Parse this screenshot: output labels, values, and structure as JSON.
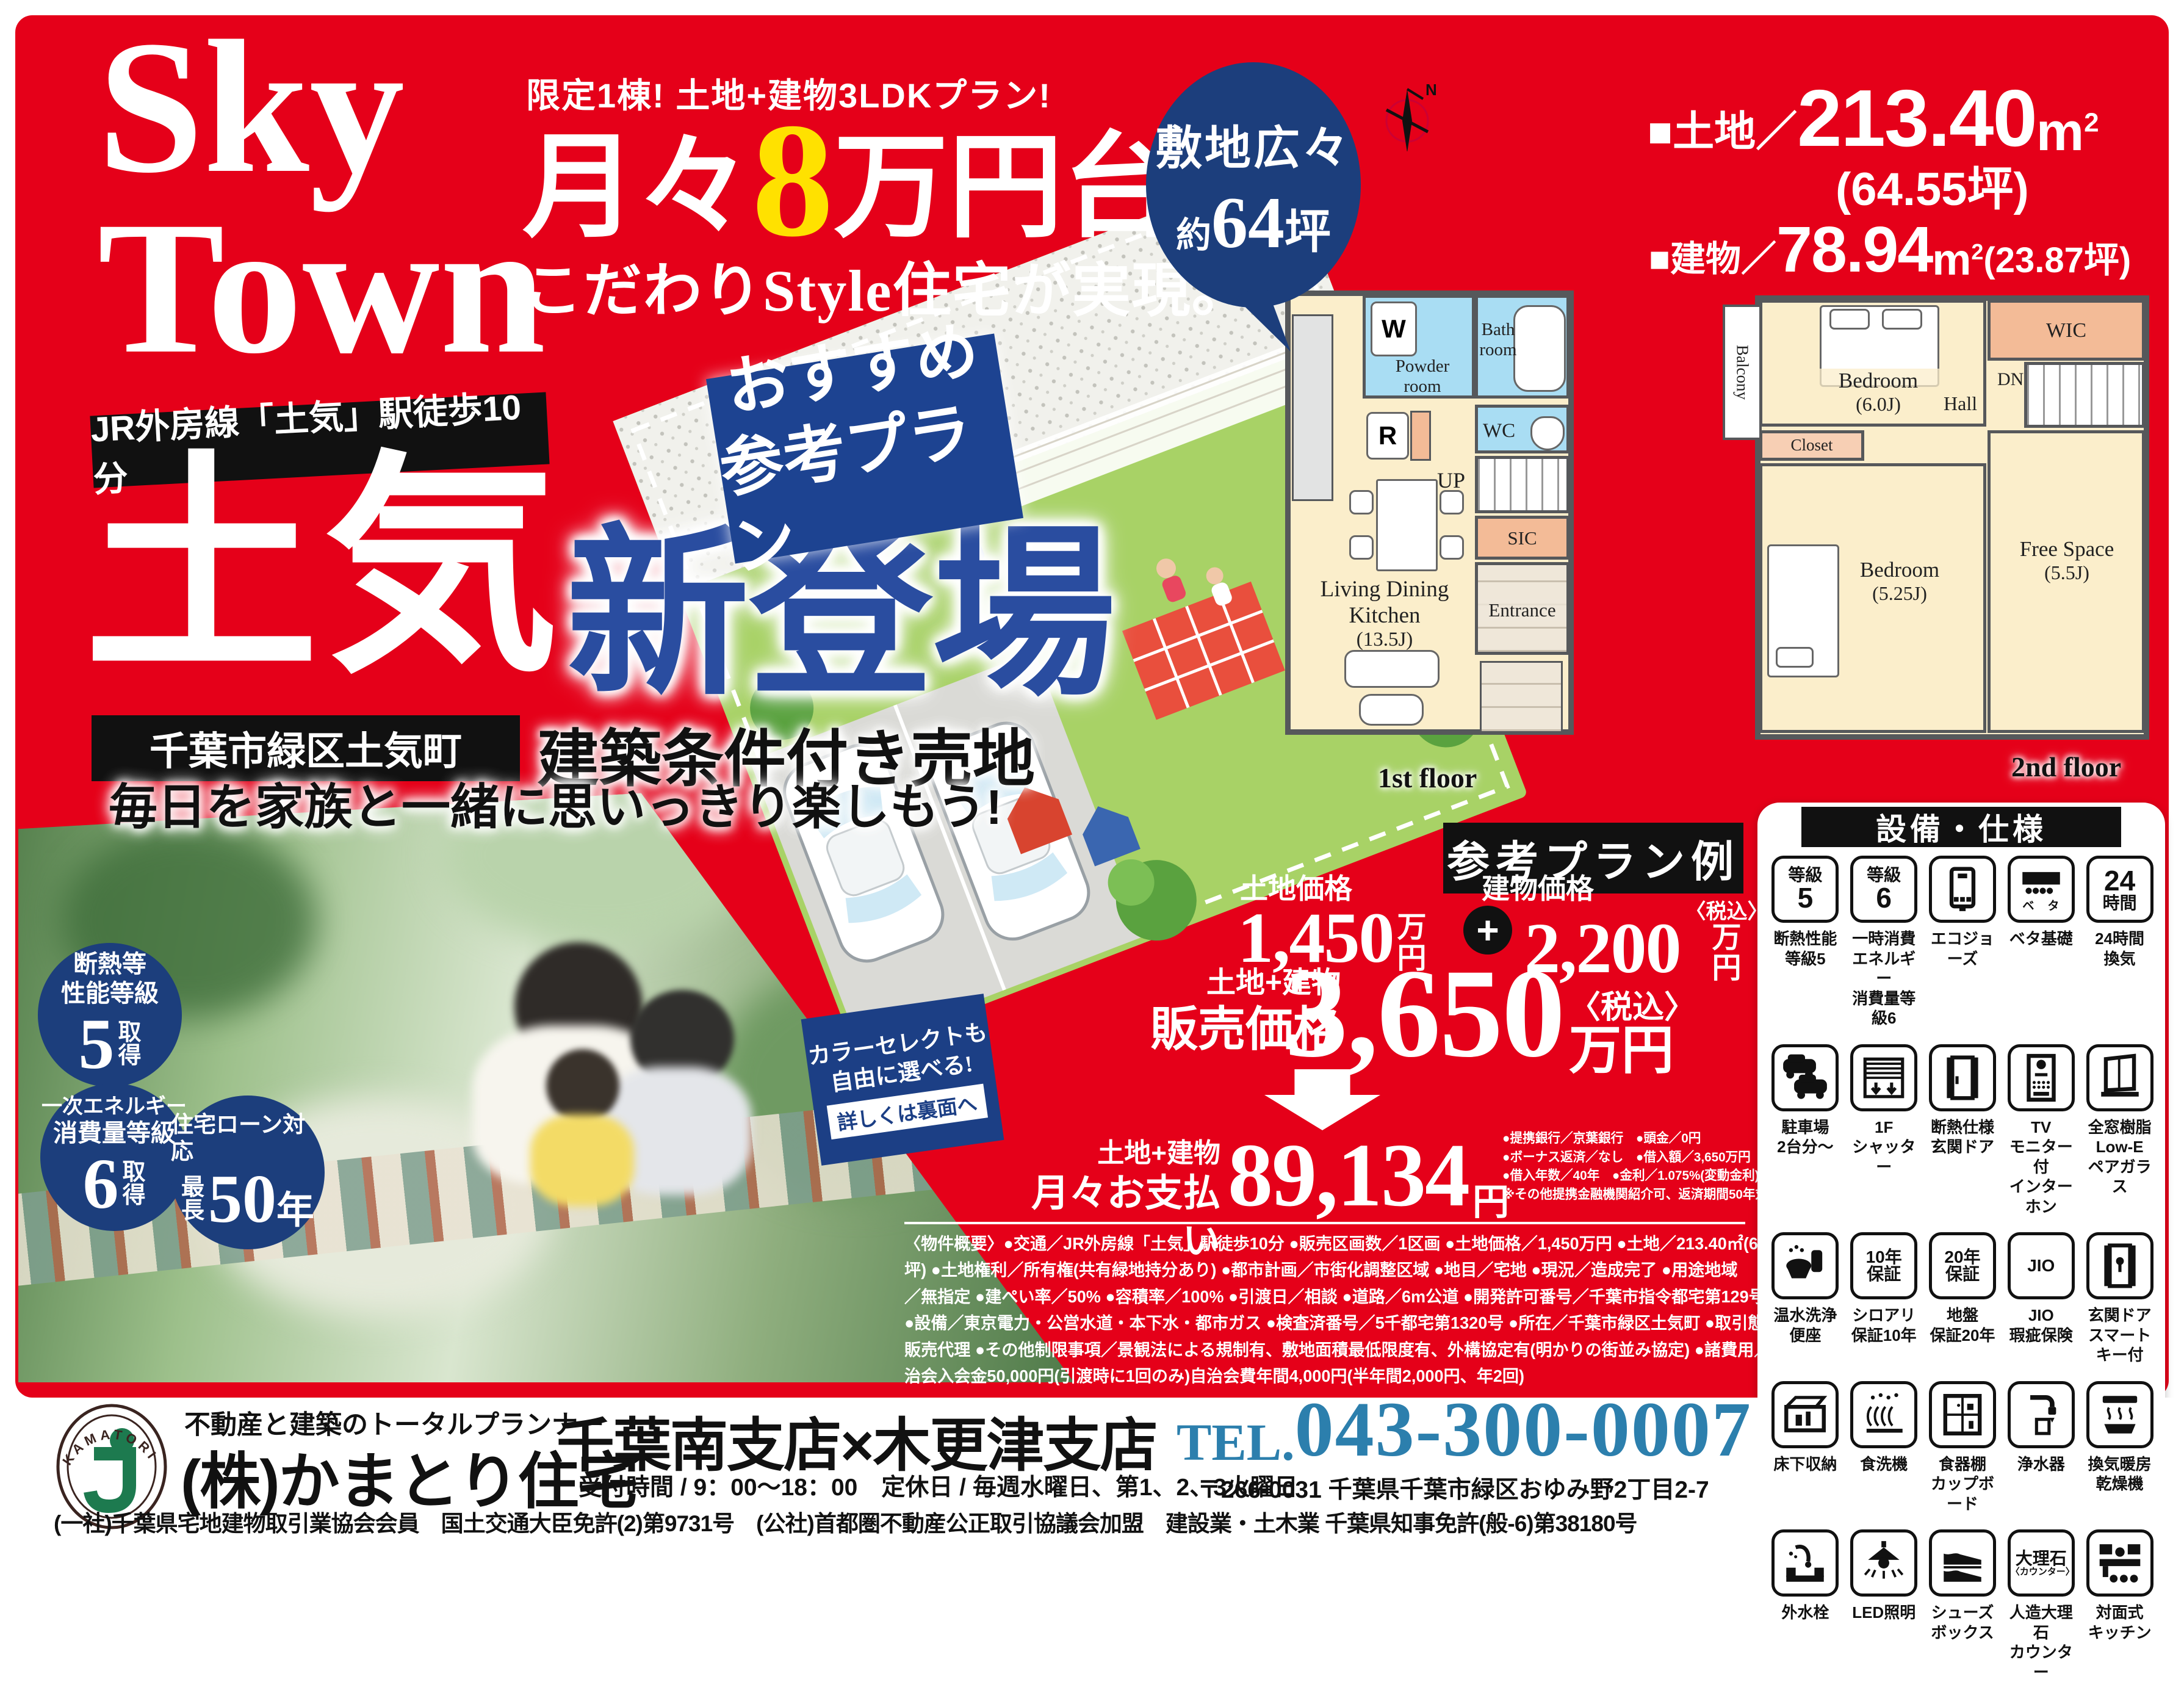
{
  "colors": {
    "red": "#e50019",
    "navy": "#1c3e7c",
    "blue": "#2a4da0",
    "badge_blue": "#1d4391",
    "tel_blue": "#2c7fad",
    "yellow": "#ffe100",
    "room_cream": "#fbeecb",
    "room_blue": "#a9ddf3",
    "room_peach": "#f3bb97",
    "wall_gray": "#56585b",
    "lawn_green": "#a8d266"
  },
  "hero": {
    "sky": "Sky",
    "town": "Town",
    "limited": "限定1棟! 土地+建物3LDKプラン!",
    "monthly_copy": {
      "pre": "月々",
      "num": "8",
      "post": "万円台で"
    },
    "kodawari": "こだわりStyle住宅が実現。",
    "station_badge": "JR外房線「土気」駅徒歩10分",
    "toke": "土気",
    "debut": "新登場",
    "osusume_l1": "おすすめ",
    "osusume_l2": "参考プラン",
    "area_badge": "千葉市緑区土気町",
    "joken": "建築条件付き売地",
    "tagline": "毎日を家族と一緒に思いっきり楽しもう!"
  },
  "site": {
    "bubble_l1": "敷地広々",
    "bubble_yaku": "約",
    "bubble_num": "64",
    "bubble_tsubo": "坪",
    "land_label": "■土地／",
    "land_num": "213.40",
    "land_unit": "m",
    "land_sup": "2",
    "land_tsubo": "(64.55坪)",
    "bldg_label": "■建物／",
    "bldg_num": "78.94",
    "bldg_unit": "m",
    "bldg_sup": "2",
    "bldg_tsubo": "(23.87坪)",
    "compass_n": "N"
  },
  "fp1": {
    "w": "W",
    "powder": "Powder room",
    "bath": "Bath room",
    "r": "R",
    "wc": "WC",
    "up": "UP",
    "sic": "SIC",
    "ldk1": "Living Dining",
    "ldk2": "Kitchen",
    "ldk3": "(13.5J)",
    "entrance": "Entrance",
    "floor": "1st floor"
  },
  "fp2": {
    "balcony": "Balcony",
    "bed1a": "Bedroom",
    "bed1b": "(6.0J)",
    "wic": "WIC",
    "dn": "DN",
    "hall": "Hall",
    "closet": "Closet",
    "bed2a": "Bedroom",
    "bed2b": "(5.25J)",
    "freea": "Free Space",
    "freeb": "(5.5J)",
    "floor": "2nd floor"
  },
  "badges": {
    "b1": {
      "l1": "断熱等",
      "l2": "性能等級",
      "num": "5",
      "suf1": "取",
      "suf2": "得"
    },
    "b2": {
      "l1": "一次エネルギー",
      "l2": "消費量等級",
      "num": "6",
      "suf1": "取",
      "suf2": "得"
    },
    "b3": {
      "l1": "住宅ローン対応",
      "pre1": "最",
      "pre2": "長",
      "num": "50",
      "suf": "年"
    }
  },
  "color_select": {
    "l1": "カラーセレクトも",
    "l2": "自由に選べる!",
    "link": "詳しくは裏面へ"
  },
  "plan": {
    "banner": "参考プラン例",
    "land_price_label": "土地価格",
    "land_price": "1,450",
    "man": "万",
    "en": "円",
    "plus": "+",
    "bldg_price_label": "建物価格",
    "bldg_price": "2,200",
    "tax": "〈税込〉",
    "total_label_a": "土地+建物",
    "total_label_b": "販売価格",
    "total": "3,650",
    "total_unit": "万円",
    "monthly_label_a": "土地+建物",
    "monthly_label_b": "月々お支払い",
    "monthly": "89,134",
    "monthly_unit": "円",
    "loan_notes": [
      "●提携銀行／京葉銀行　●頭金／0円",
      "●ボーナス返済／なし　●借入額／3,650万円",
      "●借入年数／40年　●金利／1.075%(変動金利)",
      "※その他提携金融機関紹介可、返済期間50年対応可"
    ]
  },
  "overview": {
    "lines": [
      "〈物件概要〉●交通／JR外房線「土気」駅徒歩10分 ●販売区画数／1区画 ●土地価格／1,450万円 ●土地／213.40㎡(64.55",
      "坪) ●土地権利／所有権(共有緑地持分あり) ●都市計画／市街化調整区域 ●地目／宅地 ●現況／造成完了 ●用途地域",
      "／無指定 ●建ぺい率／50% ●容積率／100% ●引渡日／相談 ●道路／6m公道 ●開発許可番号／千葉市指令都宅第129号",
      "●設備／東京電力・公営水道・本下水・都市ガス ●検査済番号／5千都宅第1320号 ●所在／千葉市緑区土気町 ●取引態様／",
      "販売代理 ●その他制限事項／景観法による規制有、敷地面積最低限度有、外構協定有(明かりの街並み協定) ●諸費用／自",
      "治会入会金50,000円(引渡時に1回のみ)自治会費年間4,000円(半年間2,000円、年2回)"
    ]
  },
  "equipment": {
    "title": "設備・仕様",
    "items": [
      {
        "icon": "grade5-icon",
        "text": [
          "等級",
          "5"
        ],
        "label": [
          "断熱性能",
          "等級5"
        ]
      },
      {
        "icon": "grade6-icon",
        "text": [
          "等級",
          "6"
        ],
        "label": [
          "一時消費",
          "エネルギー",
          "消費量等級6"
        ]
      },
      {
        "icon": "water-heater-icon",
        "label": [
          "エコジョーズ"
        ]
      },
      {
        "icon": "foundation-icon",
        "label": [
          "ベタ基礎"
        ]
      },
      {
        "icon": "vent24-icon",
        "text": [
          "24",
          "時間"
        ],
        "label": [
          "24時間",
          "換気"
        ]
      },
      {
        "icon": "cars-icon",
        "label": [
          "駐車場",
          "2台分～"
        ]
      },
      {
        "icon": "shutter-icon",
        "label": [
          "1F",
          "シャッター"
        ]
      },
      {
        "icon": "insulated-door-icon",
        "label": [
          "断熱仕様",
          "玄関ドア"
        ]
      },
      {
        "icon": "intercom-icon",
        "label": [
          "TV",
          "モニター付",
          "インターホン"
        ]
      },
      {
        "icon": "pair-glass-icon",
        "label": [
          "全窓樹脂",
          "Low-E",
          "ペアガラス"
        ]
      },
      {
        "icon": "washlet-icon",
        "label": [
          "温水洗浄",
          "便座"
        ]
      },
      {
        "icon": "warranty10-icon",
        "text": [
          "10年",
          "保証"
        ],
        "label": [
          "シロアリ",
          "保証10年"
        ]
      },
      {
        "icon": "warranty20-icon",
        "text": [
          "20年",
          "保証"
        ],
        "label": [
          "地盤",
          "保証20年"
        ]
      },
      {
        "icon": "jio-icon",
        "text": [
          "JIO"
        ],
        "label": [
          "JIO",
          "瑕疵保険"
        ]
      },
      {
        "icon": "smartkey-door-icon",
        "label": [
          "玄関ドア",
          "スマートキー付"
        ]
      },
      {
        "icon": "underfloor-icon",
        "label": [
          "床下収納"
        ]
      },
      {
        "icon": "dishwasher-icon",
        "label": [
          "食洗機"
        ]
      },
      {
        "icon": "cupboard-icon",
        "label": [
          "食器棚",
          "カップボード"
        ]
      },
      {
        "icon": "water-purifier-icon",
        "text": [],
        "label": [
          "浄水器"
        ]
      },
      {
        "icon": "bath-dryer-icon",
        "label": [
          "換気暖房",
          "乾燥機"
        ]
      },
      {
        "icon": "outdoor-faucet-icon",
        "label": [
          "外水栓"
        ]
      },
      {
        "icon": "led-icon",
        "label": [
          "LED照明"
        ]
      },
      {
        "icon": "shoebox-icon",
        "label": [
          "シューズ",
          "ボックス"
        ]
      },
      {
        "icon": "marble-icon",
        "text": [
          "大理石",
          "〈カウンター〉"
        ],
        "label": [
          "人造大理石",
          "カウンター"
        ]
      },
      {
        "icon": "kitchen-icon",
        "label": [
          "対面式",
          "キッチン"
        ]
      }
    ]
  },
  "footer": {
    "logo": "KAMATORI",
    "logo_j": "j",
    "tagline": "不動産と建築のトータルプランナー",
    "company": "(株)かまとり住宅",
    "branches": "千葉南支店×木更津支店",
    "hours": "受付時間 / 9：00～18：00　定休日 / 毎週水曜日、第1、2、3火曜日",
    "tel_label": "TEL.",
    "tel": "043-300-0007",
    "address": "〒266-0031 千葉県千葉市緑区おゆみ野2丁目2-7",
    "license": "(一社)千葉県宅地建物取引業協会会員　国土交通大臣免許(2)第9731号　(公社)首都圏不動産公正取引協議会加盟　建設業・土木業 千葉県知事免許(般-6)第38180号"
  }
}
